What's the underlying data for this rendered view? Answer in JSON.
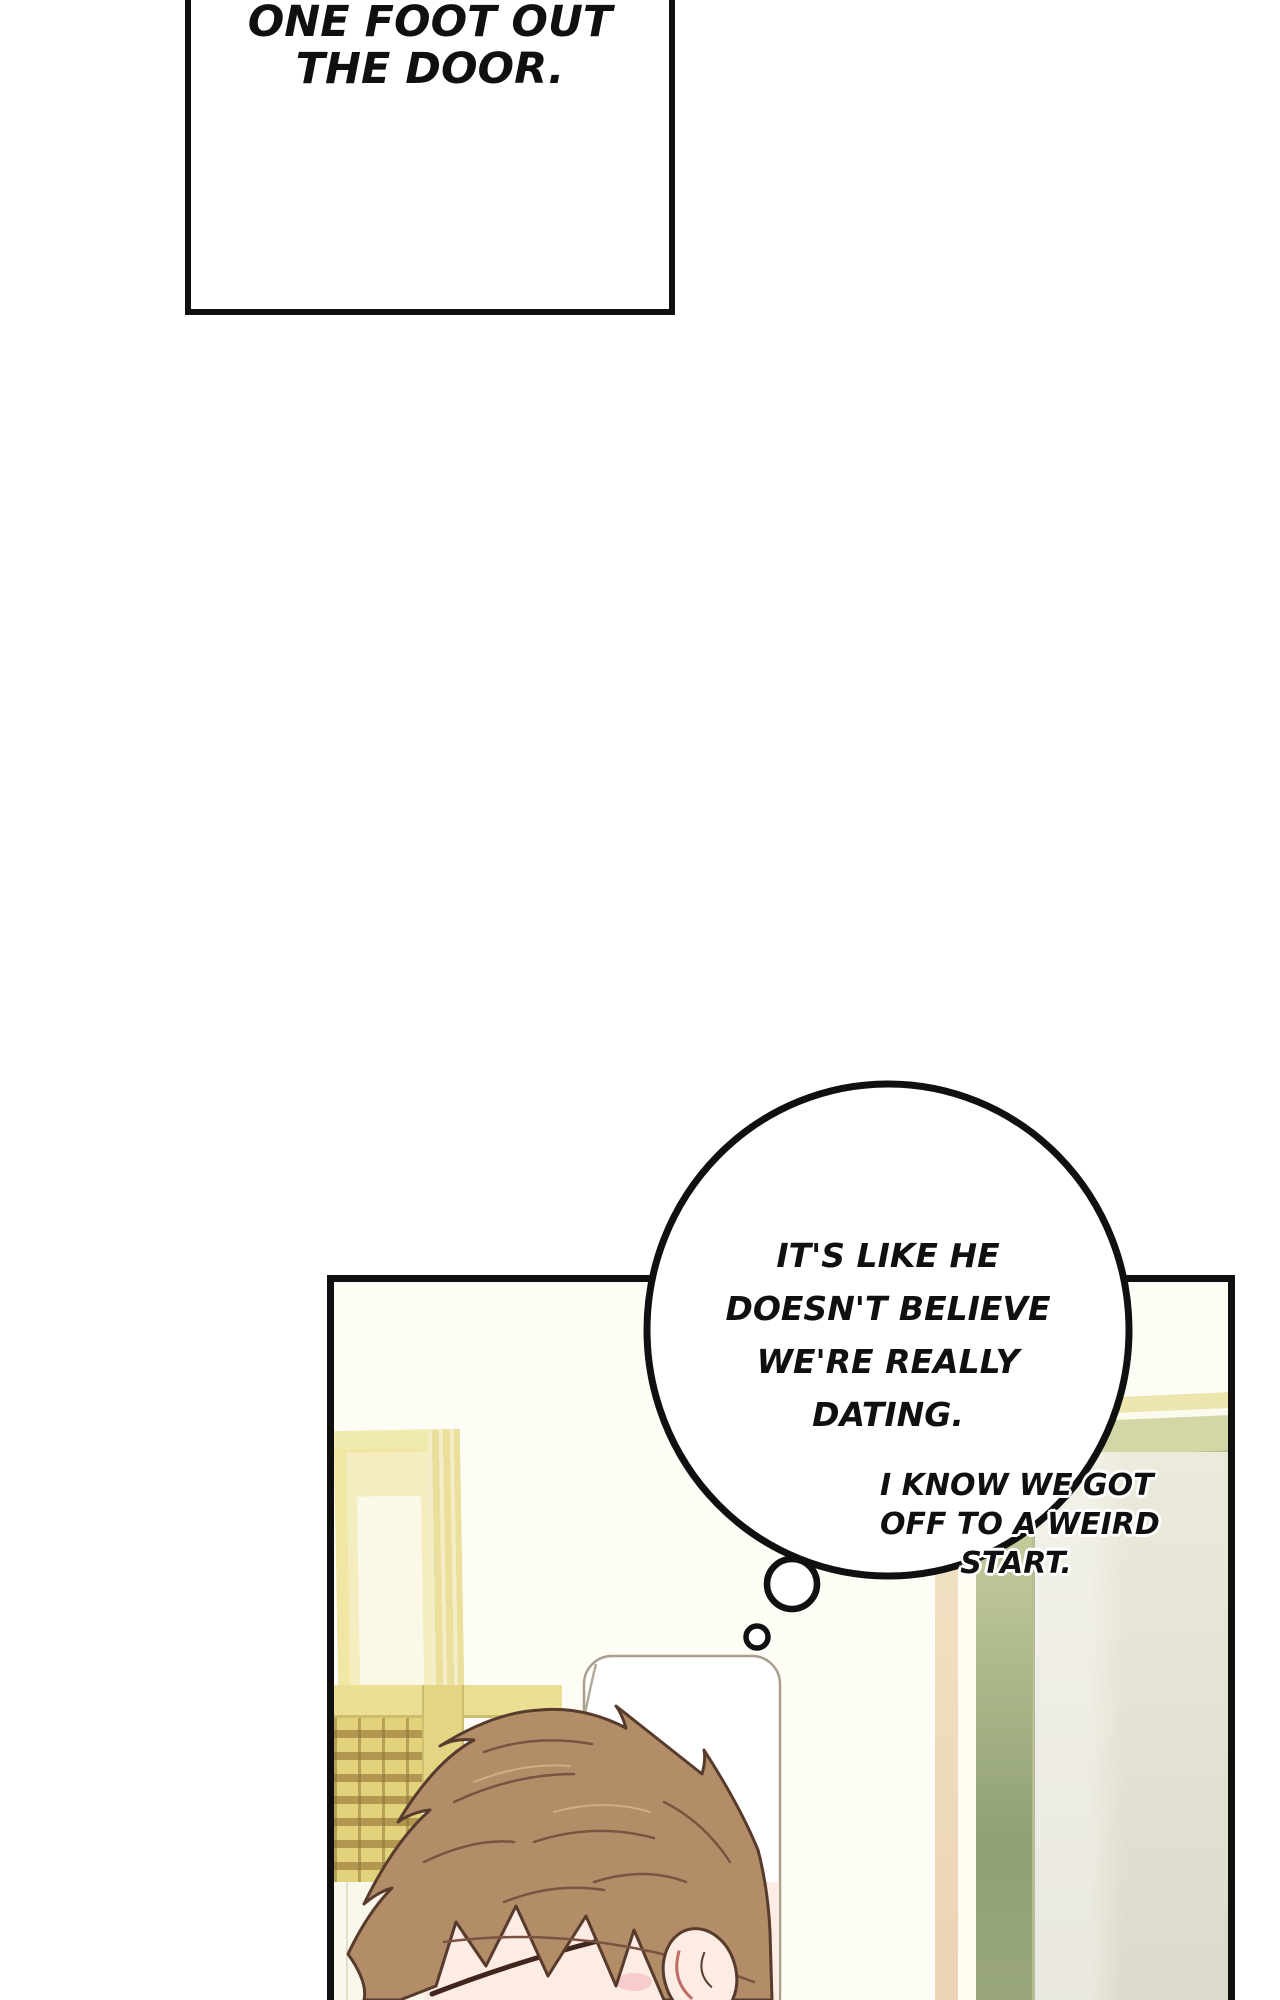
{
  "caption": {
    "lines": [
      "ONE FOOT OUT",
      "THE DOOR."
    ]
  },
  "thought_bubble": {
    "lines": [
      "IT'S LIKE HE",
      "DOESN'T BELIEVE",
      "WE'RE REALLY",
      "DATING."
    ]
  },
  "side_text": {
    "lines": [
      "I KNOW WE GOT",
      "OFF TO A WEIRD",
      "START."
    ]
  },
  "colors": {
    "ink": "#101010",
    "wall": "#fdfcf5",
    "hair": "#b28d68",
    "hair-line": "#573b2c",
    "skin": "#fdece4",
    "blush": "#f6c3c7",
    "frame-y2": "#efe7a3",
    "beam": "#eadf92",
    "door-olive2": "#8fa074",
    "door-peach2": "#ecd2b6",
    "door-face1": "#eceadb"
  }
}
